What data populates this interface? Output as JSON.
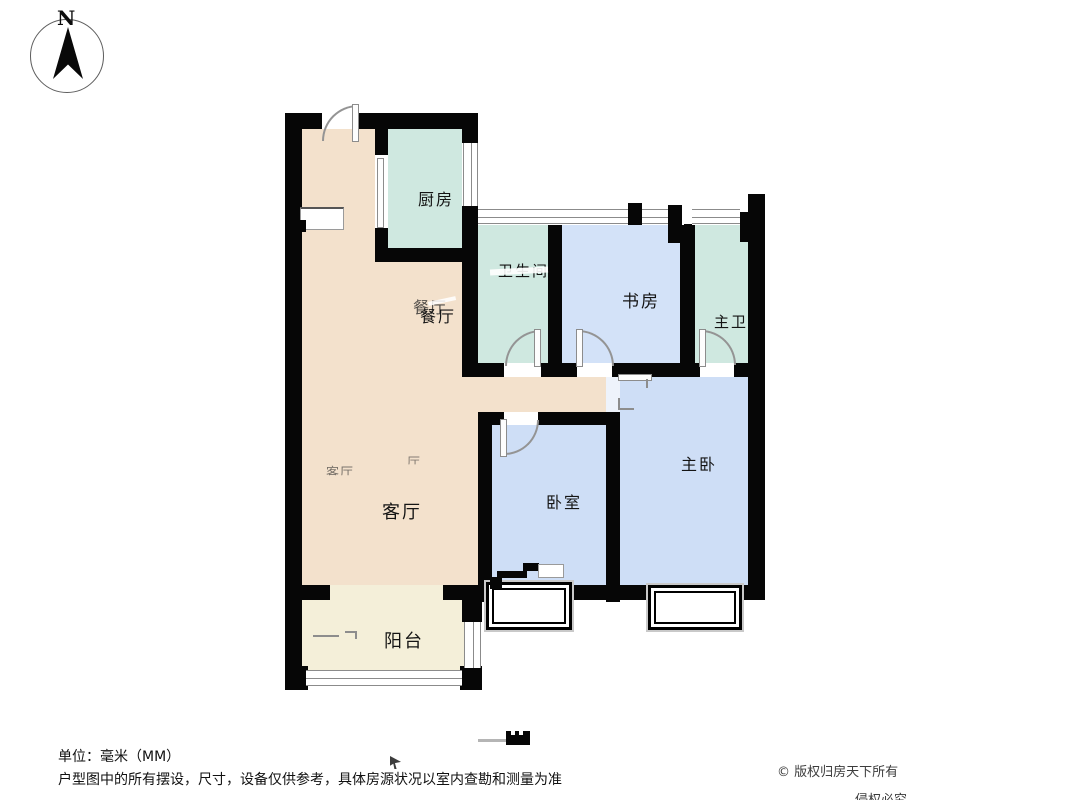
{
  "compass": {
    "north_label": "N"
  },
  "rooms": {
    "kitchen": "厨房",
    "bathroom": "卫生间",
    "study": "书房",
    "master_bath": "主卫",
    "dining": "餐厅",
    "living": "客厅",
    "bedroom": "卧室",
    "master_bedroom": "主卧",
    "balcony": "阳台"
  },
  "ghosts": {
    "dining": "餐厅",
    "living_a": "客厅",
    "living_b": "厅"
  },
  "footer": {
    "unit_note": "单位：毫米（MM）",
    "disclaimer": "户型图中的所有摆设，尺寸，设备仅供参考，具体房源状况以室内查勘和测量为准",
    "copyright": "© 版权归房天下所有",
    "copyright_line2": "侵权必究"
  },
  "colors": {
    "wall": "#060606",
    "hall_tan": "#f3e1cc",
    "wet_room_teal": "#cfe8e0",
    "study_blue": "#d3e2f8",
    "bedroom_blue": "#cedef6",
    "balcony_cream": "#f4efd9"
  }
}
